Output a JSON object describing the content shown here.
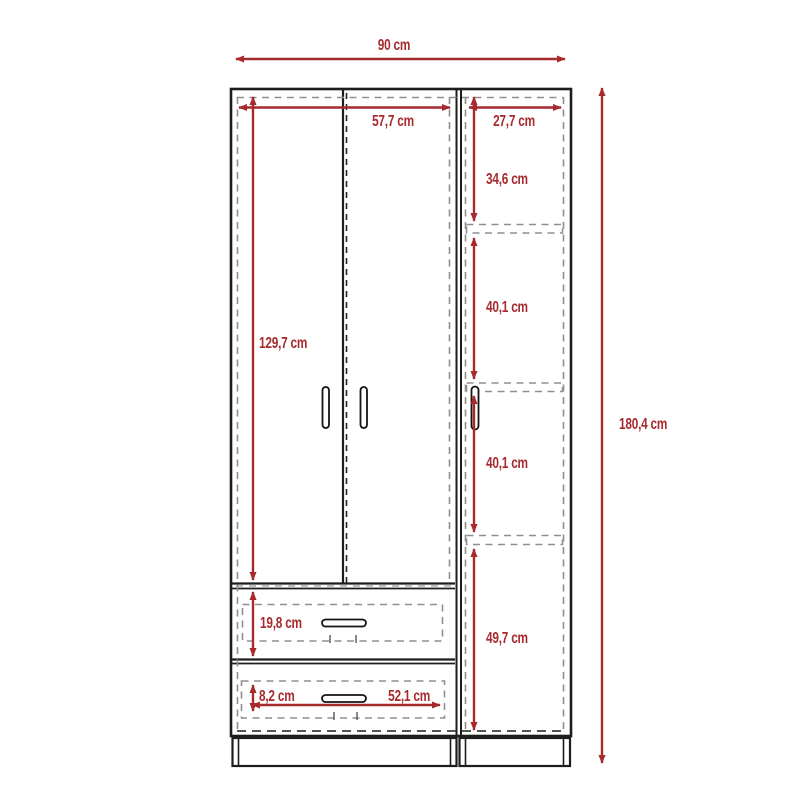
{
  "diagram": {
    "type": "furniture technical drawing",
    "subject": "wardrobe front elevation: two hinged doors with handles, side column with shelves and door, two drawers, plinth base",
    "unit": "cm",
    "accent_color": "#a62a2e",
    "outline_color": "#1d1d1b",
    "hidden_line_color": "#8f8f8f"
  },
  "dims": {
    "width_total": "90 cm",
    "width_doors": "57,7 cm",
    "width_side": "27,7 cm",
    "height_total": "180,4 cm",
    "height_doors": "129,7 cm",
    "shelf_top": "34,6 cm",
    "shelf_mid_upper": "40,1 cm",
    "shelf_mid_lower": "40,1 cm",
    "shelf_bottom": "49,7 cm",
    "drawer_top_height": "19,8 cm",
    "drawer_bottom_height": "8,2 cm",
    "drawer_width": "52,1 cm"
  }
}
